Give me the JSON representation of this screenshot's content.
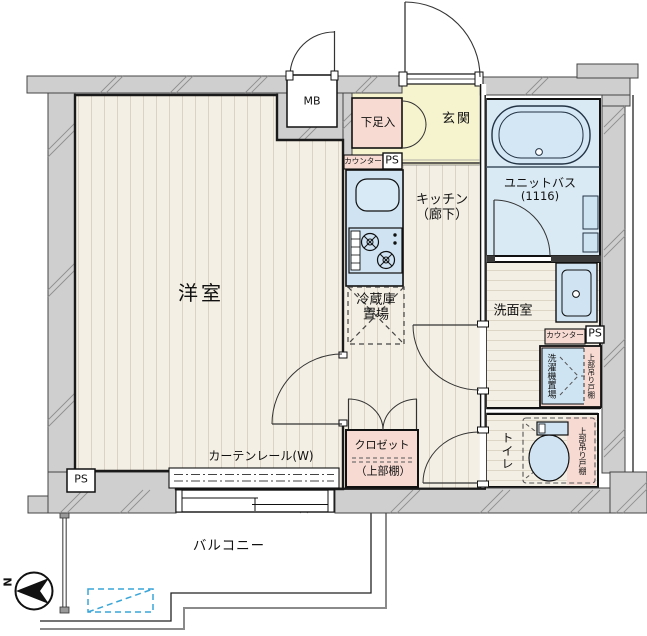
{
  "plan": {
    "western_room": "洋室",
    "kitchen": "キッチン",
    "kitchen_note": "（廊下）",
    "entrance": "玄関",
    "unit_bath": "ユニットバス",
    "unit_bath_size": "(1116)",
    "washroom": "洗面室",
    "toilet": "トイレ",
    "closet": "クロゼット",
    "closet_note": "（上部棚）",
    "shoe_box": "下足入",
    "refrigerator_line1": "冷蔵庫",
    "refrigerator_line2": "置場",
    "washing_machine_space": "洗濯機置場",
    "upper_hanging_cabinet": "上部吊り戸棚",
    "counter": "カウンター",
    "pipe_space": "PS",
    "meter_box": "MB",
    "curtain_rail": "カーテンレール(W)",
    "balcony": "バルコニー",
    "north": "N"
  },
  "colors": {
    "wall_gray": "#cfcfcf",
    "floor_cream": "#f4efe4",
    "floor_stripe": "#dad2c2",
    "bath_blue": "#d9eaf5",
    "fixture_blue": "#cfe3f2",
    "accent_pink": "#f7dbd3",
    "entrance_yellow": "#f6f3cf",
    "hatch_dashed_blue": "#3aa5d8"
  }
}
